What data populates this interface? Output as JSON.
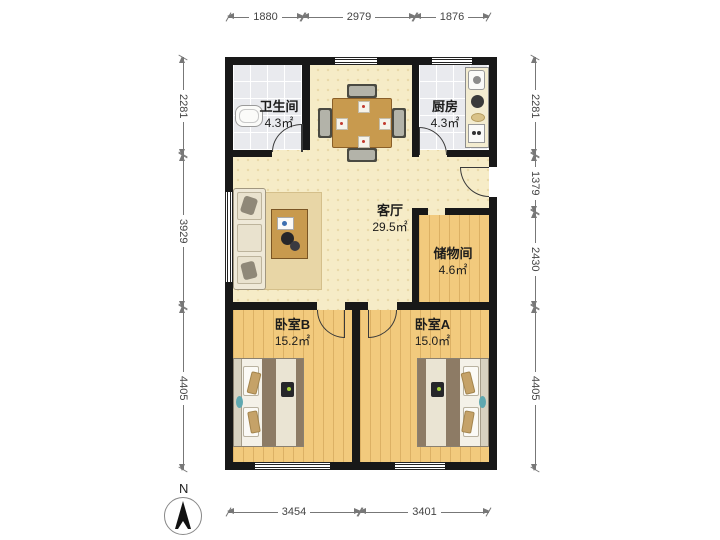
{
  "compass": {
    "label": "N"
  },
  "rooms": {
    "bathroom": {
      "name": "卫生间",
      "area": "4.3㎡"
    },
    "kitchen": {
      "name": "厨房",
      "area": "4.3㎡"
    },
    "living": {
      "name": "客厅",
      "area": "29.5㎡"
    },
    "storage": {
      "name": "储物间",
      "area": "4.6㎡"
    },
    "bedroom_b": {
      "name": "卧室B",
      "area": "15.2㎡"
    },
    "bedroom_a": {
      "name": "卧室A",
      "area": "15.0㎡"
    }
  },
  "dimensions_mm": {
    "top": [
      "1880",
      "2979",
      "1876"
    ],
    "bottom": [
      "3454",
      "3401"
    ],
    "left": [
      "2281",
      "3929",
      "4405"
    ],
    "right": [
      "2281",
      "1379",
      "2430",
      "4405"
    ]
  },
  "colors": {
    "wall": "#181818",
    "floor_living": "#f6ecc7",
    "floor_wood": "#f2ca7d",
    "floor_tile": "#e9eaee",
    "furniture_wood": "#c89a4e",
    "dimension_text": "#444444"
  }
}
